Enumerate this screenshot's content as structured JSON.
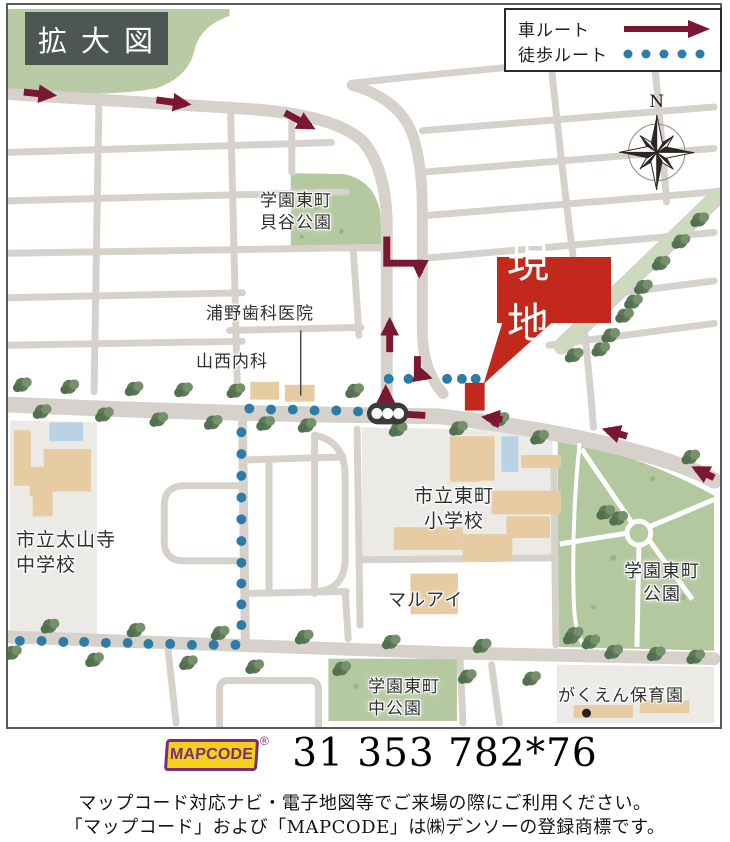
{
  "title_box": {
    "label": "拡大図"
  },
  "legend": {
    "car_label": "車ルート",
    "walk_label": "徒歩ルート"
  },
  "compass": {
    "north_label": "N"
  },
  "site_callout": {
    "label": "現地"
  },
  "map_labels": {
    "kaiya_park_l1": "学園東町",
    "kaiya_park_l2": "貝谷公園",
    "urano_dental": "浦野歯科医院",
    "yamanishi_clinic": "山西内科",
    "taisanji_l1": "市立太山寺",
    "taisanji_l2": "中学校",
    "higashimachi_l1": "市立東町",
    "higashimachi_l2": "小学校",
    "gakuen_park_l1": "学園東町",
    "gakuen_park_l2": "公園",
    "maruai": "マルアイ",
    "naka_park_l1": "学園東町",
    "naka_park_l2": "中公園",
    "hoikuen": "がくえん保育園"
  },
  "mapcode": {
    "logo_text": "MAPCODE",
    "registered_mark": "®",
    "code": "31 353 782*76"
  },
  "footer": {
    "note_line1": "マップコード対応ナビ・電子地図等でご来場の際にご利用ください。",
    "note_line2": "「マップコード」および「MAPCODE」は㈱デンソーの登録商標です。"
  },
  "colors": {
    "car_route": "#7c1733",
    "walk_route": "#2b7ca6",
    "site_red": "#c2281c",
    "road": "#d6d1cb",
    "park_green": "#b8cba4",
    "building_tan": "#e6cba3",
    "grounds_gray": "#eceae6",
    "pool_blue": "#b9d2e4",
    "mapcode_yellow": "#f1d11c",
    "mapcode_purple": "#7c2c7c",
    "title_bg": "#4d5655"
  }
}
